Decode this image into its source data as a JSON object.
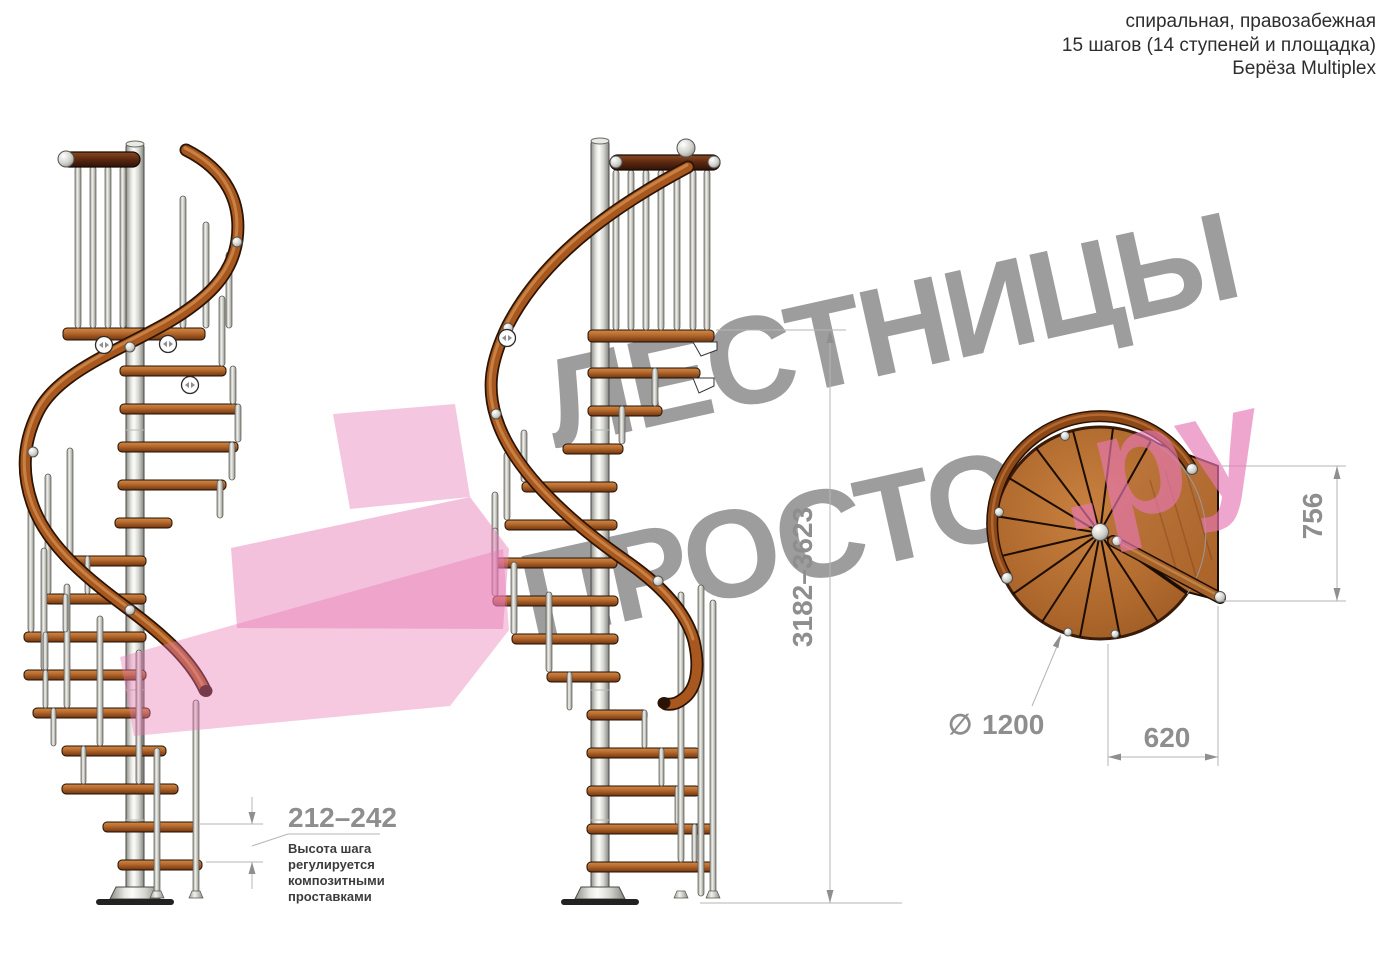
{
  "title_block": {
    "line1": "спиральная, правозабежная",
    "line2": "15 шагов (14 ступеней и площадка)",
    "line3": "Берёза Multiplex"
  },
  "watermark": {
    "brand_top": "ЛЕСТНИЦЫ",
    "brand_bottom": "ПРОСТО",
    "brand_suffix": ".ру"
  },
  "dimensions": {
    "total_height": "3182–3623",
    "step_height": "212–242",
    "landing_depth": "756",
    "landing_width": "620",
    "diameter_symbol": "∅",
    "diameter_value": "1200"
  },
  "step_note": {
    "line1": "Высота шага",
    "line2": "регулируется",
    "line3": "композитными",
    "line4": "проставками"
  },
  "colors": {
    "watermark_gray": "#9d9d9d",
    "accent_pink": "#e878b4",
    "wood_main": "#a8581e",
    "dim_text": "#8e8e8e"
  }
}
